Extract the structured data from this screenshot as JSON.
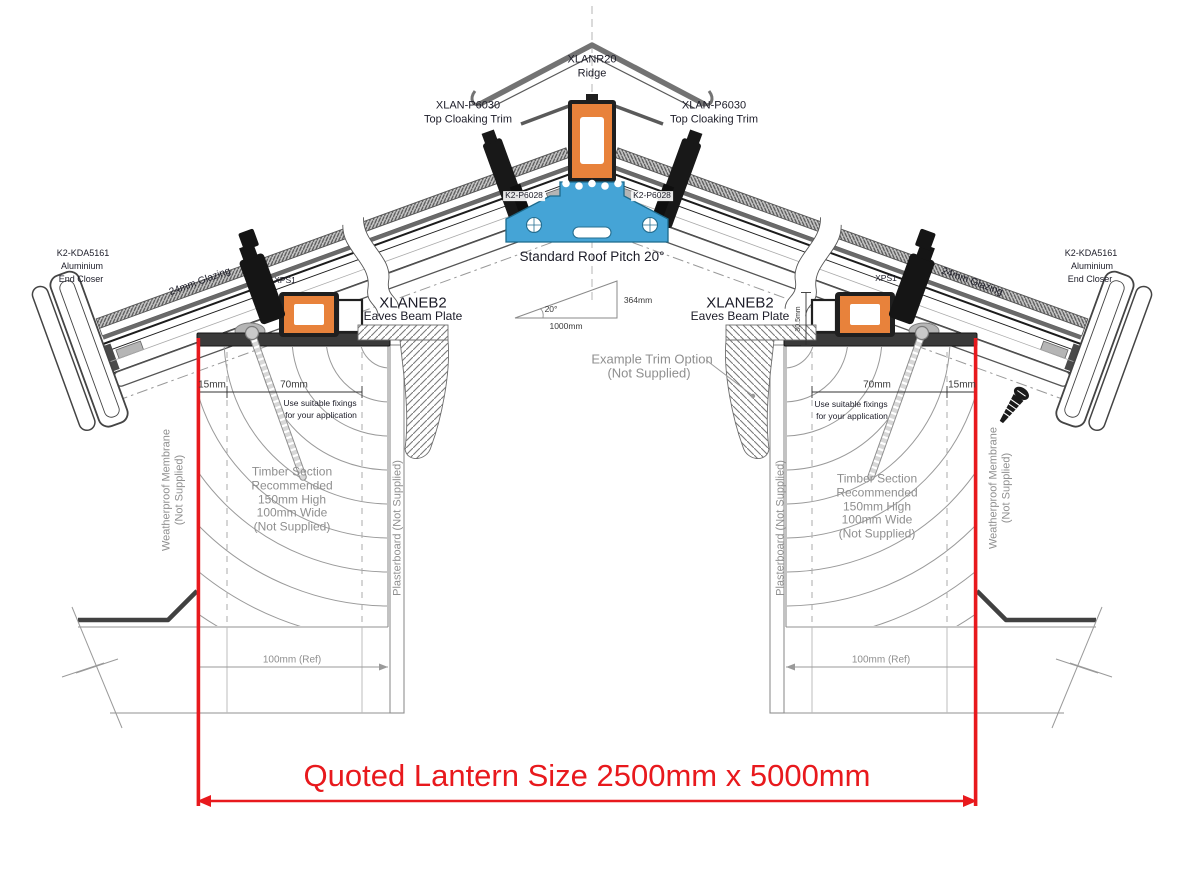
{
  "title": "Roof lantern cross-section installation drawing",
  "colors": {
    "accent_red": "#e8191d",
    "profile_orange": "#e8823b",
    "profile_blue": "#45a4d6",
    "line_dark": "#1c1c28",
    "note_gray": "#8f8f8f"
  },
  "parts": {
    "ridge": {
      "code": "XLANR20",
      "name": "Ridge"
    },
    "top_cloaking": {
      "code": "XLAN-P6030",
      "name": "Top Cloaking Trim"
    },
    "glazing_bar": {
      "code": "K2-P6028"
    },
    "end_closer": {
      "code": "K2-KDA5161",
      "material": "Aluminium",
      "name": "End Closer"
    },
    "eaves_beam": {
      "code": "XLANEB2",
      "name": "Eaves Beam Plate"
    },
    "spacer": {
      "code": "XPS1"
    },
    "glazing": {
      "label": "24mm Glazing"
    }
  },
  "pitch": {
    "title": "Standard Roof Pitch 20°",
    "angle": "20°",
    "run": "1000mm",
    "rise": "364mm"
  },
  "dimensions": {
    "edge": "15mm",
    "fixing_zone": "70mm",
    "beam_height": "30.5mm",
    "wall_ref": "100mm (Ref)",
    "quoted": "Quoted Lantern Size 2500mm x 5000mm"
  },
  "notes": {
    "fixings": [
      "Use suitable fixings",
      "for your application"
    ],
    "timber": [
      "Timber Section",
      "Recommended",
      "150mm High",
      "100mm Wide",
      "(Not Supplied)"
    ],
    "membrane": [
      "Weatherproof Membrane",
      "(Not Supplied)"
    ],
    "plasterboard": "Plasterboard (Not Supplied)",
    "trim_option": [
      "Example Trim Option",
      "(Not Supplied)"
    ]
  }
}
